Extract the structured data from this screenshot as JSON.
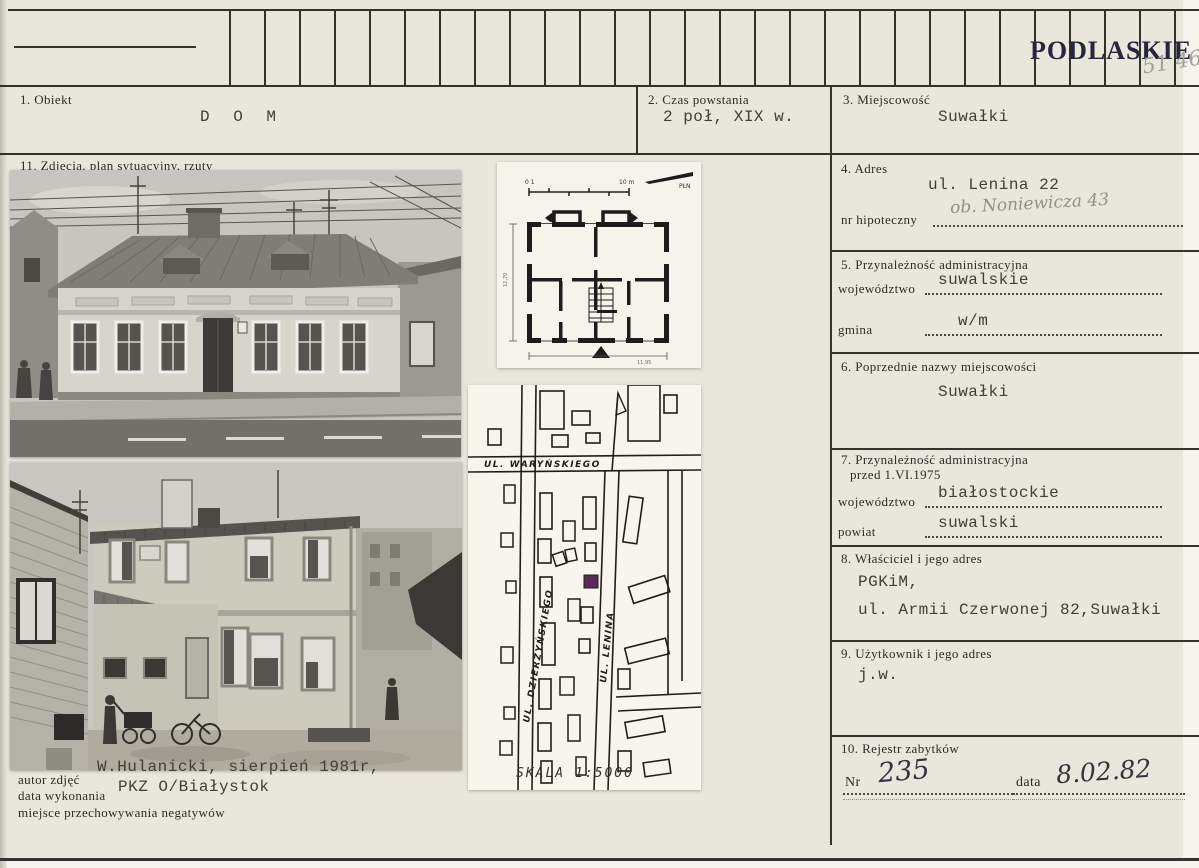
{
  "colors": {
    "paper": "#e9e6db",
    "ink": "#35332d",
    "stamp_ink": "#26263c",
    "pencil": "#a3a19b",
    "marker_purple": "#5a2a58"
  },
  "stamp": {
    "text": "PODLASKIE",
    "pencil_number": "51 46"
  },
  "fields": {
    "f1": {
      "label": "1. Obiekt",
      "value": "D O M"
    },
    "f2": {
      "label": "2. Czas powstania",
      "value": "2 poł, XIX w."
    },
    "f3": {
      "label": "3. Miejscowość",
      "value": "Suwałki"
    },
    "f4": {
      "label": "4. Adres",
      "value": "ul. Lenina 22",
      "handwritten": "ob. Noniewicza 43",
      "sub_label": "nr hipoteczny"
    },
    "f5": {
      "label": "5. Przynależność administracyjna",
      "rows": [
        {
          "label": "województwo",
          "value": "suwalskie"
        },
        {
          "label": "gmina",
          "value": "w/m"
        }
      ]
    },
    "f6": {
      "label": "6. Poprzednie nazwy miejscowości",
      "value": "Suwałki"
    },
    "f7": {
      "label": "7. Przynależność administracyjna",
      "label2": "przed 1.VI.1975",
      "rows": [
        {
          "label": "województwo",
          "value": "białostockie"
        },
        {
          "label": "powiat",
          "value": "suwalski"
        }
      ]
    },
    "f8": {
      "label": "8. Właściciel i jego adres",
      "value_line1": "PGKiM,",
      "value_line2": "ul. Armii Czerwonej 82,Suwałki"
    },
    "f9": {
      "label": "9. Użytkownik i jego adres",
      "value": "j.w."
    },
    "f10": {
      "label": "10. Rejestr zabytków",
      "nr_label": "Nr",
      "nr_value": "235",
      "date_label": "data",
      "date_value": "8.02.82"
    },
    "f11": {
      "label": "11. Zdjęcia, plan sytuacyjny, rzuty"
    }
  },
  "photo_credit": {
    "label_author": "autor zdjęć",
    "label_date": "data wykonania",
    "label_negatives": "miejsce przechowywania negatywów",
    "line1": "W.Hulanicki, sierpień 1981r,",
    "line2": "PKZ O/Białystok"
  },
  "site_map": {
    "street_warynskiego": "UL. WARYŃSKIEGO",
    "street_dzierzynskiego": "UL. DZIERŻYŃSKIEGO",
    "street_lenina": "UL. LENINA",
    "scale": "SKALA 1:5000"
  },
  "floor_plan": {
    "scale_left": "0 1",
    "scale_right": "10 m",
    "north": "PŁN",
    "dim_left": "12,70",
    "dim_bottom": "11,95"
  }
}
